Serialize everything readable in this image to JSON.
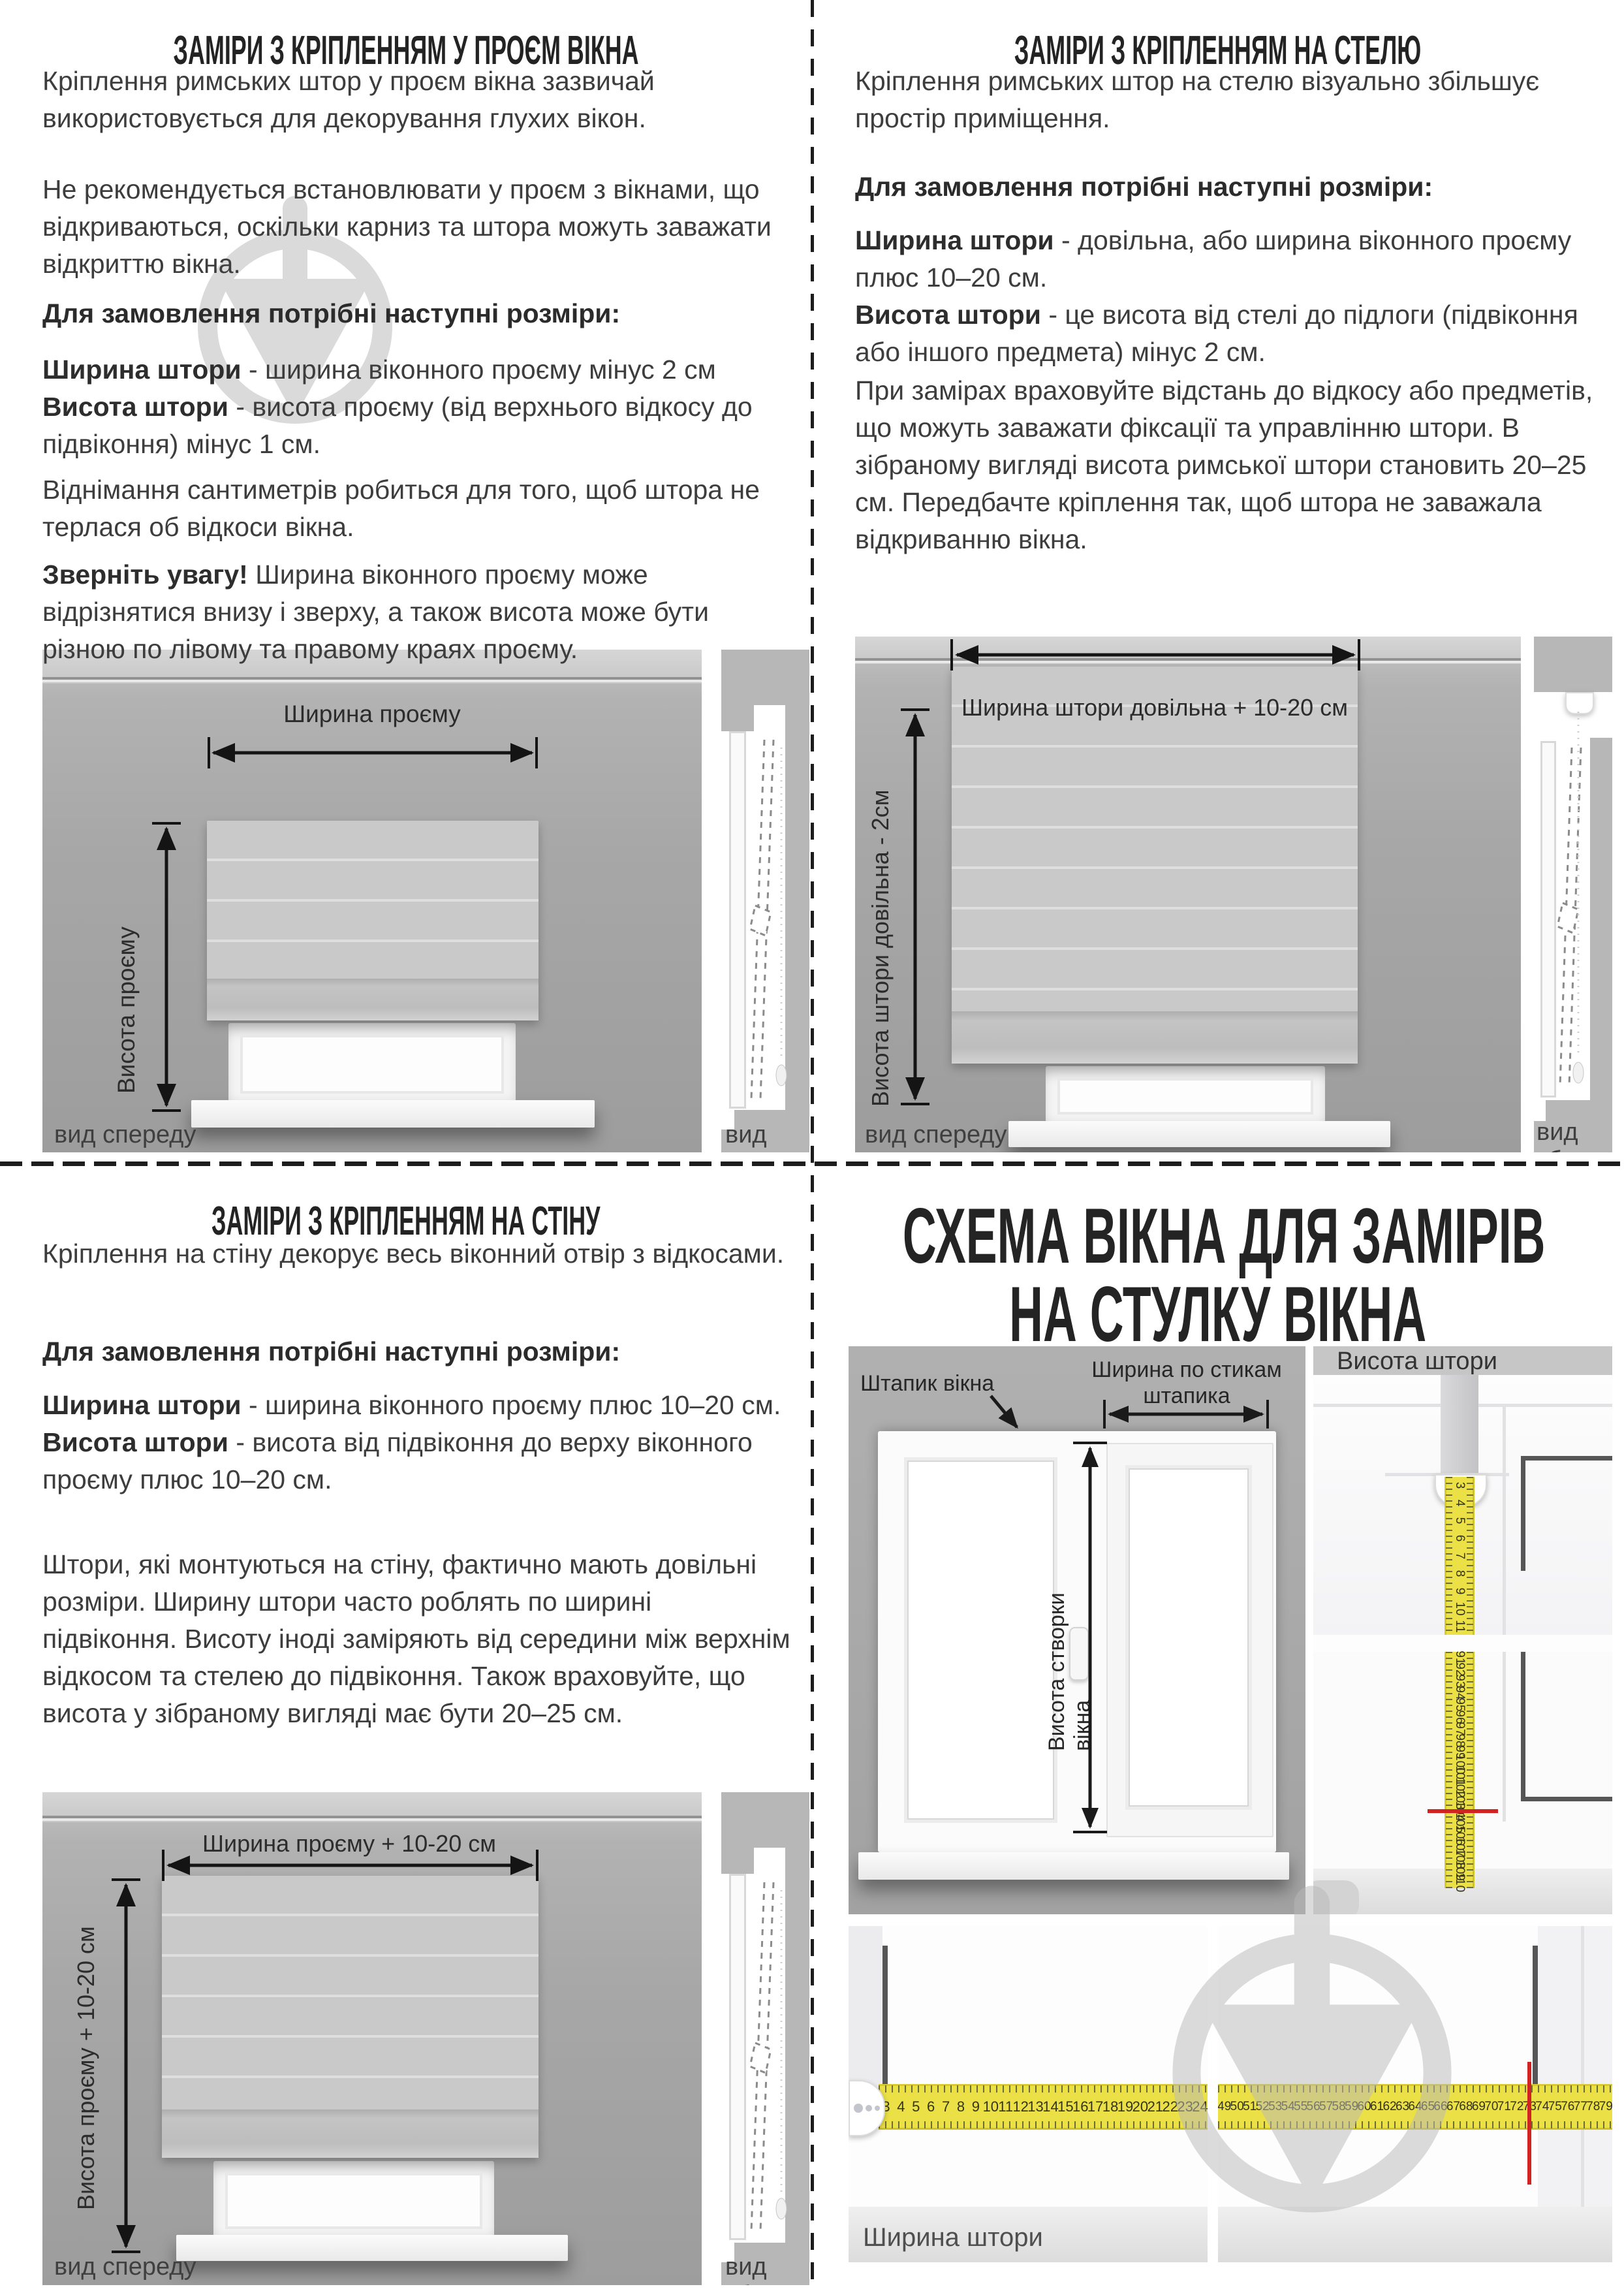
{
  "colors": {
    "tape_yellow": "#ebe045",
    "red_mark": "#d22323",
    "watermark_gray": "#dadada",
    "wall_gray": "#a7a7a7",
    "text": "#3d3d3d"
  },
  "q": {
    "tl": {
      "title": "ЗАМІРИ З КРІПЛЕННЯМ У ПРОЄМ ВІКНА",
      "p1": "Кріплення римських штор у проєм вікна зазвичай використовується для декорування глухих вікон.",
      "p2": "Не рекомендується встановлювати у проєм з вікнами, що відкриваються, оскільки карниз та штора можуть заважати відкриттю вікна.",
      "heading": "Для замовлення потрібні наступні розміри:",
      "w_term": "Ширина штори",
      "w_desc": " - ширина віконного проєму мінус 2 см",
      "h_term": "Висота штори",
      "h_desc": " - висота проєму (від верхнього відкосу до підвіконня) мінус 1 см.",
      "p4": "Віднімання сантиметрів робиться для того, щоб штора не терлася об відкоси вікна.",
      "note_term": "Зверніть увагу!",
      "note_desc": " Ширина віконного проєму може відрізнятися внизу і зверху, а також висота може бути різною по лівому та правому краях проєму.",
      "d_width": "Ширина проєму",
      "d_height": "Висота проєму",
      "cap_front": "вид спереду",
      "cap_side": "вид збоку"
    },
    "tr": {
      "title": "ЗАМІРИ З КРІПЛЕННЯМ НА СТЕЛЮ",
      "p1": "Кріплення римських штор на стелю візуально збільшує простір приміщення.",
      "heading": "Для замовлення потрібні наступні розміри:",
      "w_term": "Ширина штори",
      "w_desc": " - довільна, або ширина віконного проєму плюс 10–20 см.",
      "h_term": "Висота штори",
      "h_desc": " - це висота від стелі до підлоги (підвіконня або іншого предмета) мінус 2 см.",
      "p4": "При замірах враховуйте відстань до відкосу або предметів, що можуть заважати фіксації та управлінню штори. В зібраному вигляді висота римської штори становить 20–25 см. Передбачте кріплення так, щоб штора не заважала відкриванню вікна.",
      "d_width": "Ширина штори довільна + 10-20 см",
      "d_height": "Висота штори довільна - 2см",
      "cap_front": "вид спереду",
      "cap_side": "вид збоку"
    },
    "bl": {
      "title": "ЗАМІРИ З КРІПЛЕННЯМ НА СТІНУ",
      "p1": "Кріплення на стіну декорує весь віконний отвір з відкосами.",
      "heading": "Для замовлення потрібні наступні розміри:",
      "w_term": "Ширина штори",
      "w_desc": " - ширина віконного проєму плюс 10–20 см.",
      "h_term": "Висота штори",
      "h_desc": " - висота від підвіконня до верху віконного проєму плюс 10–20 см.",
      "p4": "Штори, які монтуються на стіну, фактично мають довільні розміри. Ширину штори часто роблять по ширині підвіконня. Висоту іноді заміряють від середини між верхнім відкосом та стелею до підвіконня. Також враховуйте, що висота у зібраному вигляді має бути 20–25 см.",
      "d_width": "Ширина проєму + 10-20 см",
      "d_height": "Висота проєму + 10-20 см",
      "cap_front": "вид спереду",
      "cap_side": "вид збоку"
    },
    "br": {
      "title1": "СХЕМА ВІКНА ДЛЯ ЗАМІРІВ",
      "title2": "НА СТУЛКУ ВІКНА",
      "bead_label": "Штапик вікна",
      "sash_width_label": "Ширина по стикам штапика",
      "sash_height_label": "Висота створки вікна",
      "height_panel_title": "Висота штори",
      "width_panel_label": "Ширина штори"
    }
  },
  "tapes": {
    "v_top": [
      3,
      4,
      5,
      6,
      7,
      8,
      9,
      10,
      11
    ],
    "v_bottom": [
      91,
      92,
      93,
      94,
      95,
      96,
      97,
      98,
      99,
      100,
      101,
      102,
      103,
      104,
      105,
      106,
      107,
      108,
      109,
      110
    ],
    "h_left": [
      3,
      4,
      5,
      6,
      7,
      8,
      9,
      10,
      11,
      12,
      13,
      14,
      15,
      16,
      17,
      18,
      19,
      20,
      21,
      22,
      23,
      24
    ],
    "h_right": [
      49,
      50,
      51,
      52,
      53,
      54,
      55,
      56,
      57,
      58,
      59,
      60,
      61,
      62,
      63,
      64,
      65,
      66,
      67,
      68,
      69,
      70,
      71,
      72,
      73,
      74,
      75,
      76,
      77,
      78,
      79
    ],
    "red_height_value": 104,
    "red_width_value": 73
  }
}
